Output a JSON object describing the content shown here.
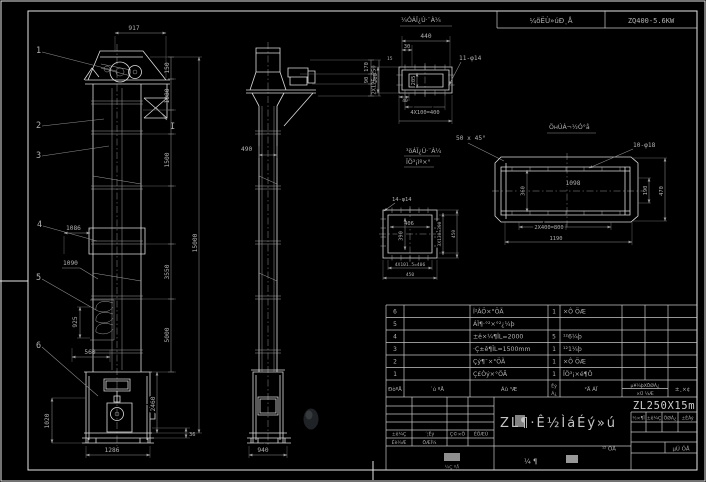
{
  "colors": {
    "background": "#000000",
    "linework": "#dcdcdc",
    "dimension": "#8f8f8f",
    "text": "#b0b0b0",
    "model_text": "#cfcfcf"
  },
  "strip": {
    "label": "¼õËÙ»úÐͺÅ",
    "value": "ZQ400-5.6KW"
  },
  "front": {
    "callouts": [
      "1",
      "2",
      "3",
      "4",
      "5",
      "6"
    ],
    "section_mark": "I",
    "dims": {
      "width_top": "917",
      "h1": "150",
      "h2": "1080",
      "h3": "1500",
      "h4": "3550",
      "h5": "5000",
      "total": "15000",
      "boot_h": "2460",
      "base": "36",
      "w1": "1086",
      "w2": "1090",
      "bucket": "925",
      "boot_front": "560",
      "boot_side": "1020",
      "boot_width": "1286"
    }
  },
  "side": {
    "dims": {
      "col_width": "490",
      "base_width": "940",
      "head1": "170",
      "head2": "90",
      "head_total": "260"
    }
  },
  "detail_a": {
    "title": "¼ÓÁÏ¿Ú·¨À¼",
    "d440": "440",
    "d30": "30",
    "d15": "15",
    "d40": "40",
    "holes": "11-φ14",
    "left": "2X125=250",
    "inner": "205",
    "pitch": "4X100=400"
  },
  "chamfer": {
    "note": "50 x 45°",
    "label1": "³öÁÏ¿Ú·¨À¼",
    "label2": "ÏÖ³¡ìº×°"
  },
  "trough": {
    "title": "ÖнÚÁ¬½Ó°å",
    "holes": "10-φ18",
    "d1098": "1098",
    "d360": "360",
    "d190": "190",
    "d470": "470",
    "pitch": "2X400=800",
    "d1190": "1190"
  },
  "detail_c": {
    "holes": "14-φ14",
    "inner_w": "406",
    "inner_h": "390",
    "right_pitch": "3X130=390",
    "right_out": "450",
    "bottom_pitch": "4X101.5=406",
    "bottom_out": "450"
  },
  "bom": {
    "header": {
      "no": "ÐòºÅ",
      "code": "´ú ºÅ",
      "name": "Ãû ³Æ",
      "qty_top": "Êý",
      "qty_bottom": "Á¿",
      "mat": "²Ä ÁÏ",
      "weight_top": "µ¥¼þXÖØÁ¿",
      "weight_bottom": "×Ü ¼Æ",
      "note": "±¸×¢"
    },
    "rows": [
      {
        "no": "6",
        "name": "Î²ÂÖ×°ÖÃ",
        "qty": "1",
        "mat": "×Ô ÖÆ"
      },
      {
        "no": "5",
        "name": "ÁÏ¶·°²×°²¿¼þ",
        "qty": "",
        "mat": ""
      },
      {
        "no": "4",
        "name": "±ê×¼¶ÎL=2000",
        "qty": "5",
        "mat": "¹²6¼þ"
      },
      {
        "no": "3",
        "name": "·Ç±ê¶ÎL=1500mm",
        "qty": "1",
        "mat": "¹²1¼þ"
      },
      {
        "no": "2",
        "name": "Çý¶¯×°ÖÃ",
        "qty": "1",
        "mat": "×Ô ÖÆ"
      },
      {
        "no": "1",
        "name": "Ç£Òý×°ÖÃ",
        "qty": "1",
        "mat": "ÏÖ³¡×é¶Ô"
      }
    ]
  },
  "title_block": {
    "title": "ZL¶·Ê½ÌáÉý»ú",
    "model": "ZL250X15m",
    "rev_headers": [
      "±ê¼Ç",
      "´¦Êý",
      "Ç©×Ö",
      "ÈÕÆÚ"
    ],
    "rev_row": [
      "Éè¼Æ",
      "ÖÆÍ¼"
    ],
    "stamp_text": "¼Ç ºÅ",
    "mid_chars": "¼    ¶",
    "info_headers": [
      "½×¶Î",
      "±ê¼Ç",
      "ÖØÁ¿",
      "±ÈÀý"
    ],
    "sheet_total": "¹² ÕÅ",
    "sheet_no": "µÚ ÕÅ"
  }
}
